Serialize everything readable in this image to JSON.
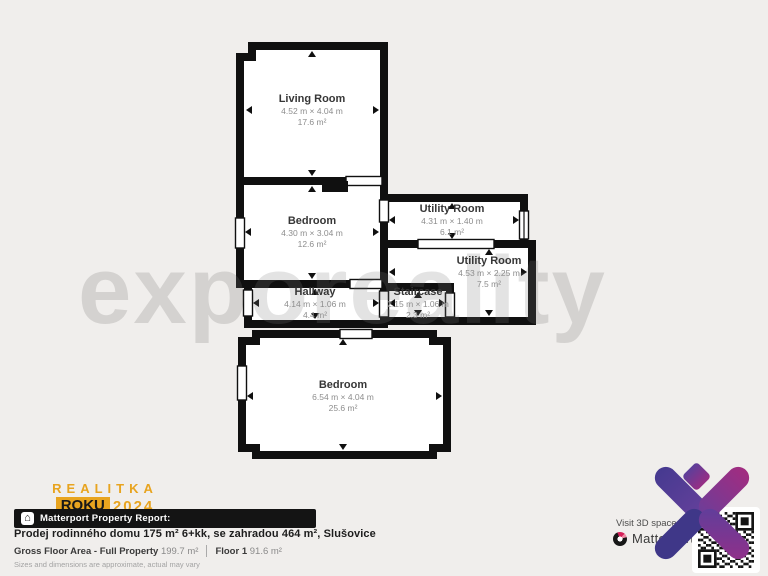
{
  "floor_plan": {
    "watermark": "exporeality",
    "rooms": [
      {
        "name": "Living Room",
        "dims": "4.52 m × 4.04 m",
        "area": "17.6 m²"
      },
      {
        "name": "Bedroom",
        "dims": "4.30 m × 3.04 m",
        "area": "12.6 m²"
      },
      {
        "name": "Utility Room",
        "dims": "4.31 m × 1.40 m",
        "area": "6.1 m²"
      },
      {
        "name": "Utility Room",
        "dims": "4.53 m × 2.25 m",
        "area": "7.5 m²"
      },
      {
        "name": "Hallway",
        "dims": "4.14 m × 1.06 m",
        "area": "4.4 m²"
      },
      {
        "name": "Staircase",
        "dims": "2.15 m × 1.06 m",
        "area": "2.3 m²"
      },
      {
        "name": "Bedroom",
        "dims": "6.54 m × 4.04 m",
        "area": "25.6 m²"
      }
    ]
  },
  "award": {
    "line1": "REALITKA",
    "roku": "ROKU",
    "year": "2024",
    "line3": "VÍTĚZ OKRESU"
  },
  "badge": {
    "icon": "building-icon",
    "label": "Matterport Property Report:"
  },
  "listing": {
    "title": "Prodej rodinného domu 175 m² 6+kk, se zahradou 464 m², Slušovice",
    "stats": [
      {
        "label": "Gross Floor Area - Full Property",
        "value": "199.7 m²"
      },
      {
        "label": "Floor 1",
        "value": "91.6 m²"
      }
    ],
    "disclaimer": "Sizes and dimensions are approximate, actual may vary"
  },
  "footer_right": {
    "visit_text": "Visit 3D space at",
    "brand": "Matterport"
  },
  "colors": {
    "background": "#f0eeec",
    "wall": "#101010",
    "accent_gold": "#e8a41f",
    "logo_purple": "#463a90",
    "logo_magenta": "#982e84",
    "matterport_red": "#d5215a"
  }
}
